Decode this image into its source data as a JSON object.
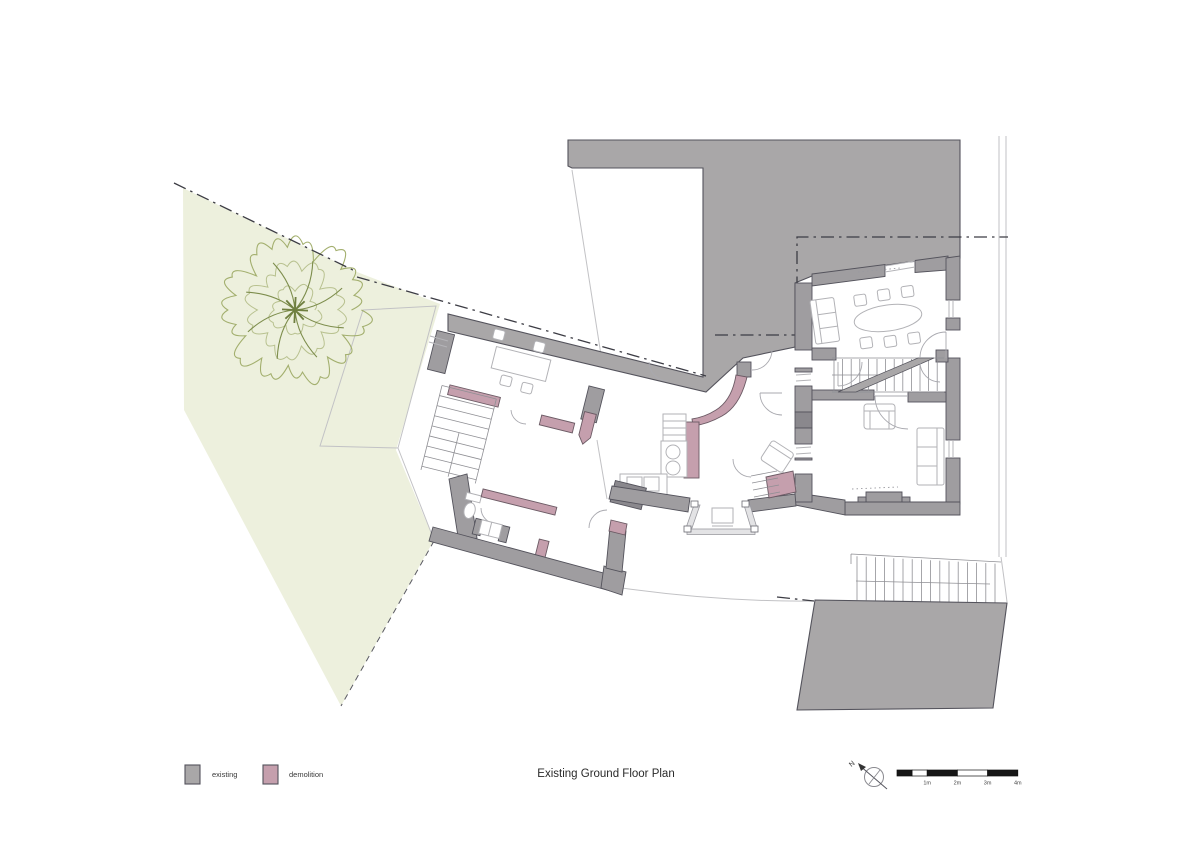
{
  "title": "Existing Ground Floor Plan",
  "legend": {
    "items": [
      {
        "label": "existing",
        "color": "#a9a7a8"
      },
      {
        "label": "demolition",
        "color": "#c59fad"
      }
    ]
  },
  "north_arrow": {
    "label": "N"
  },
  "scale_bar": {
    "labels": [
      "1m",
      "2m",
      "3m",
      "4m"
    ]
  },
  "colors": {
    "existing": "#a9a7a8",
    "demolition": "#c59fad",
    "wall": "#9f9da0",
    "garden": "#edf0dd",
    "tree_outline": "#a3af6e",
    "tree_branch": "#7d8d4c",
    "wall_outline": "#54535c",
    "boundary": "#3c3c44"
  }
}
